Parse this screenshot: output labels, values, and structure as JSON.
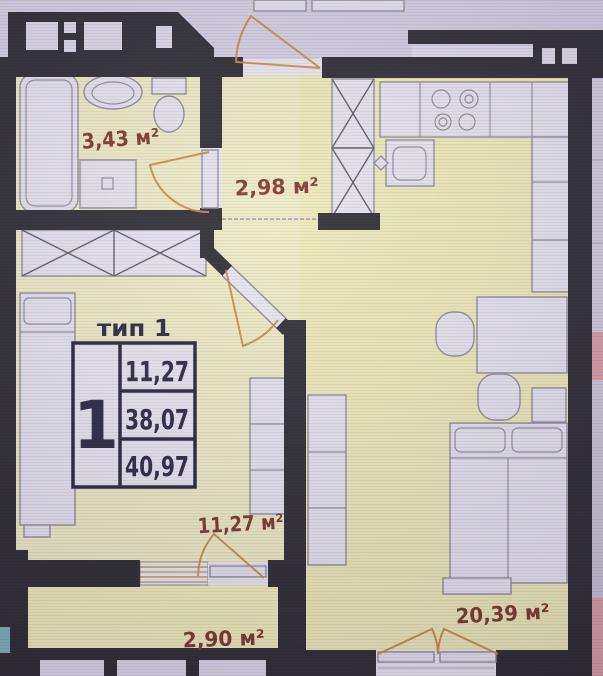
{
  "plan": {
    "stamp": {
      "title": "тип 1",
      "rooms_count": "1",
      "rows": [
        "11,27",
        "38,07",
        "40,97"
      ]
    },
    "labels": {
      "bathroom": "3,43 м²",
      "hallway": "2,98 м²",
      "living_room": "11,27 м²",
      "balcony": "2,90 м²",
      "kitchen_living_room": "20,39 м²"
    },
    "colors": {
      "walls": "#26242b",
      "room_fill": "#edeac3",
      "balcony_fill": "#f0ecb8",
      "door_arc": "#c5853b",
      "area_label": "#7c3026",
      "stamp_text": "#23203c",
      "neighbor_pink": "#d79aa0",
      "neighbor_teal": "#79b0b6",
      "background": "#cdc8da"
    }
  }
}
